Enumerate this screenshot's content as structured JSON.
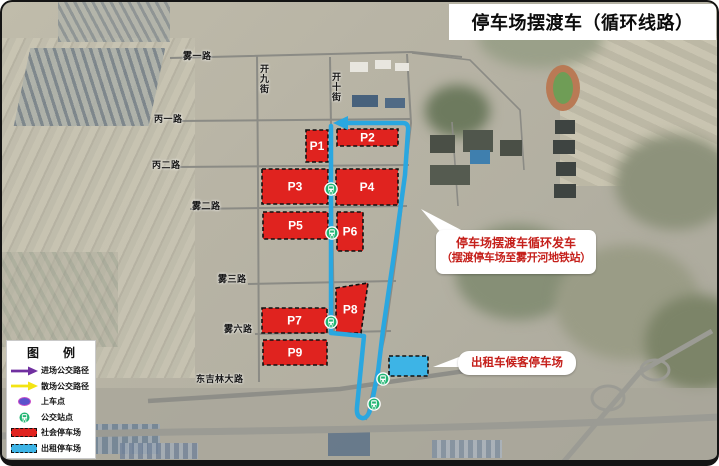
{
  "title": "停车场摆渡车（循环线路）",
  "legend": {
    "title": "图　例",
    "items": [
      {
        "icon": "purple-arrow-icon",
        "label": "进场公交路径"
      },
      {
        "icon": "yellow-arrow-icon",
        "label": "散场公交路径"
      },
      {
        "icon": "boarding-point-icon",
        "label": "上车点"
      },
      {
        "icon": "bus-stop-icon",
        "label": "公交站点"
      },
      {
        "icon": "social-parking-swatch",
        "label": "社会停车场"
      },
      {
        "icon": "taxi-parking-swatch",
        "label": "出租停车场"
      }
    ]
  },
  "callouts": {
    "shuttle": {
      "line1": "停车场摆渡车循环发车",
      "line2": "（摆渡停车场至雾开河地铁站）"
    },
    "taxi": {
      "text": "出租车候客停车场"
    }
  },
  "roads": [
    {
      "name": "雾一路",
      "x": 183,
      "y": 49,
      "dir": "h"
    },
    {
      "name": "开九街",
      "x": 258,
      "y": 64,
      "dir": "v"
    },
    {
      "name": "开十街",
      "x": 330,
      "y": 72,
      "dir": "v"
    },
    {
      "name": "丙一路",
      "x": 154,
      "y": 112,
      "dir": "h"
    },
    {
      "name": "丙二路",
      "x": 152,
      "y": 158,
      "dir": "h"
    },
    {
      "name": "雾二路",
      "x": 192,
      "y": 199,
      "dir": "h"
    },
    {
      "name": "雾三路",
      "x": 218,
      "y": 272,
      "dir": "h"
    },
    {
      "name": "雾六路",
      "x": 224,
      "y": 322,
      "dir": "h"
    },
    {
      "name": "东吉林大路",
      "x": 196,
      "y": 372,
      "dir": "h"
    }
  ],
  "parking_lots": [
    {
      "id": "P1",
      "label": "P1",
      "type": "social",
      "x": 306,
      "y": 130,
      "w": 22,
      "h": 32
    },
    {
      "id": "P2",
      "label": "P2",
      "type": "social",
      "x": 337,
      "y": 129,
      "w": 61,
      "h": 17
    },
    {
      "id": "P3",
      "label": "P3",
      "type": "social",
      "x": 262,
      "y": 169,
      "w": 66,
      "h": 35
    },
    {
      "id": "P4",
      "label": "P4",
      "type": "social",
      "x": 336,
      "y": 169,
      "w": 62,
      "h": 36
    },
    {
      "id": "P5",
      "label": "P5",
      "type": "social",
      "x": 263,
      "y": 212,
      "w": 65,
      "h": 27
    },
    {
      "id": "P6",
      "label": "P6",
      "type": "social",
      "x": 337,
      "y": 212,
      "w": 26,
      "h": 39
    },
    {
      "id": "P7",
      "label": "P7",
      "type": "social",
      "x": 262,
      "y": 308,
      "w": 65,
      "h": 25
    },
    {
      "id": "P8",
      "label": "P8",
      "type": "social",
      "poly": [
        [
          336,
          288
        ],
        [
          368,
          283
        ],
        [
          361,
          333
        ],
        [
          336,
          333
        ]
      ]
    },
    {
      "id": "P9",
      "label": "P9",
      "type": "social",
      "x": 263,
      "y": 340,
      "w": 64,
      "h": 25
    },
    {
      "id": "taxi-lot",
      "label": "",
      "type": "taxi",
      "x": 389,
      "y": 356,
      "w": 39,
      "h": 20
    }
  ],
  "bus_stops": [
    {
      "x": 331,
      "y": 189
    },
    {
      "x": 332,
      "y": 233
    },
    {
      "x": 331,
      "y": 322
    },
    {
      "x": 383,
      "y": 379
    },
    {
      "x": 374,
      "y": 404
    }
  ],
  "colors": {
    "route_blue": "#2aa7e0",
    "social_red": "#e0231f",
    "taxi_blue": "#3db4e6",
    "callout_red": "#c5201b",
    "legend_purple": "#7030a0",
    "legend_yellow": "#f3e413",
    "bus_green": "#22b573"
  }
}
